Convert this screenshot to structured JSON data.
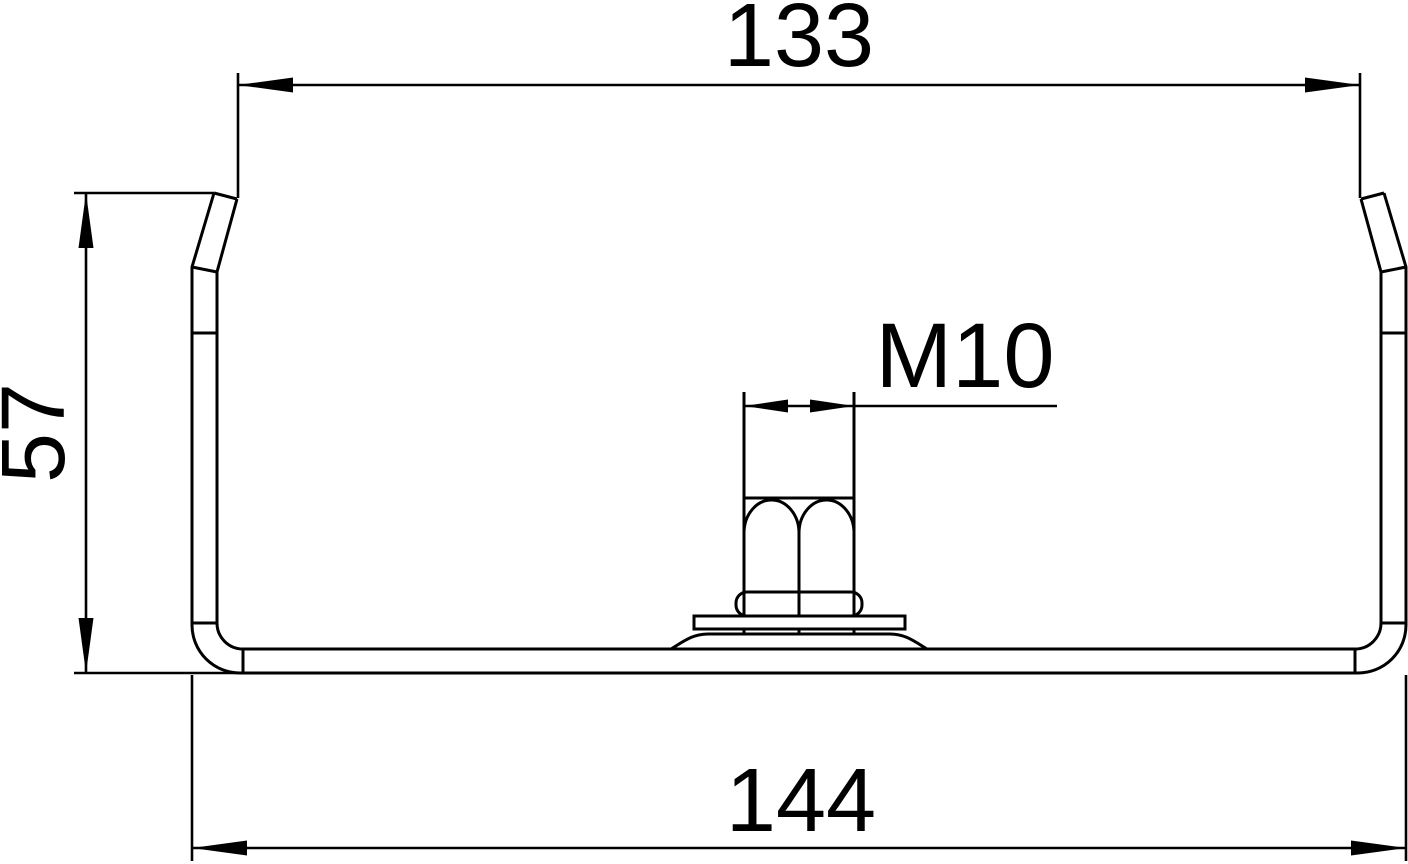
{
  "drawing": {
    "background_color": "#ffffff",
    "line_color": "#000000",
    "dimensions": {
      "top_width": {
        "label": "133"
      },
      "height": {
        "label": "57"
      },
      "thread": {
        "label": "M10"
      },
      "bottom_width": {
        "label": "144"
      }
    }
  }
}
